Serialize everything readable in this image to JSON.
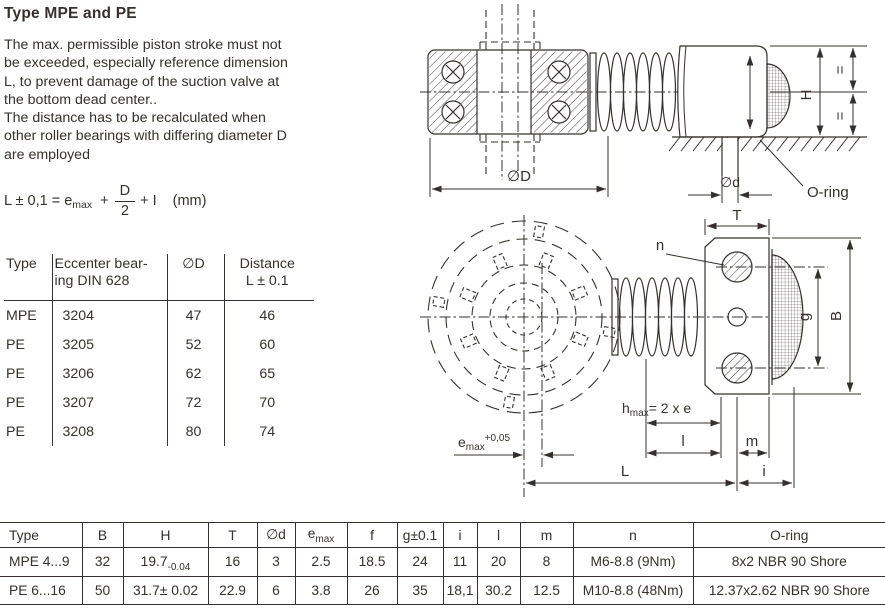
{
  "colors": {
    "text": "#35302e",
    "line": "#35302e",
    "background": "#ffffff"
  },
  "header": {
    "title": "Type MPE and PE"
  },
  "intro": {
    "lines": [
      "The max. permissible piston stroke must not",
      "be exceeded, especially reference dimension",
      "L, to prevent damage of the suction valve at",
      "the bottom dead center..",
      "The distance has to be recalculated when",
      "other roller bearings with differing diameter D",
      "are employed"
    ]
  },
  "formula": {
    "prefix": "L ± 0,1 = e",
    "sub": "max",
    "plus": "+",
    "num": "D",
    "den": "2",
    "suffix": "+ I",
    "unit": "(mm)"
  },
  "bearing_table": {
    "headers": {
      "type": "Type",
      "bearing_l1": "Eccenter bear-",
      "bearing_l2": "ing DIN 628",
      "dia": "∅D",
      "distance_l1": "Distance",
      "distance_l2": "L ± 0.1"
    },
    "rows": [
      {
        "type": "MPE",
        "bearing": "3204",
        "dia": "47",
        "distance": "46"
      },
      {
        "type": "PE",
        "bearing": "3205",
        "dia": "52",
        "distance": "60"
      },
      {
        "type": "PE",
        "bearing": "3206",
        "dia": "62",
        "distance": "65"
      },
      {
        "type": "PE",
        "bearing": "3207",
        "dia": "72",
        "distance": "70"
      },
      {
        "type": "PE",
        "bearing": "3208",
        "dia": "80",
        "distance": "74"
      }
    ]
  },
  "dim_table": {
    "headers": {
      "type": "Type",
      "b": "B",
      "h": "H",
      "t": "T",
      "d": "∅d",
      "e_base": "e",
      "e_sub": "max",
      "f": "f",
      "g": "g±0.1",
      "i": "i",
      "l": "l",
      "m": "m",
      "n": "n",
      "oring": "O-ring"
    },
    "rows": [
      {
        "type": "MPE 4...9",
        "b": "32",
        "h_base": "19.7",
        "h_tol": "-0.04",
        "t": "16",
        "d": "3",
        "e": "2.5",
        "f": "18.5",
        "g": "24",
        "i": "11",
        "l": "20",
        "m": "8",
        "n": "M6-8.8 (9Nm)",
        "oring": "8x2 NBR 90 Shore"
      },
      {
        "type": "PE 6...16",
        "b": "50",
        "h_base": "31.7± 0.02",
        "h_tol": "",
        "t": "22.9",
        "d": "6",
        "e": "3.8",
        "f": "26",
        "g": "35",
        "i": "18,1",
        "l": "30.2",
        "m": "12.5",
        "n": "M10-8.8 (48Nm)",
        "oring": "12.37x2.62 NBR 90 Shore"
      }
    ]
  },
  "drawing_upper": {
    "dia_D": "∅D",
    "dia_d": "∅d",
    "h": "H",
    "eq_top": "=",
    "eq_bottom": "=",
    "oring": "O-ring"
  },
  "drawing_lower": {
    "t": "T",
    "n": "n",
    "g": "g",
    "b": "B",
    "hmax_base": "h",
    "hmax_sub": "max",
    "hmax_rest": "= 2 x e",
    "emax_base": "e",
    "emax_sub": "max",
    "emax_sup": "+0,05",
    "l": "l",
    "m": "m",
    "L": "L",
    "i": "i"
  }
}
